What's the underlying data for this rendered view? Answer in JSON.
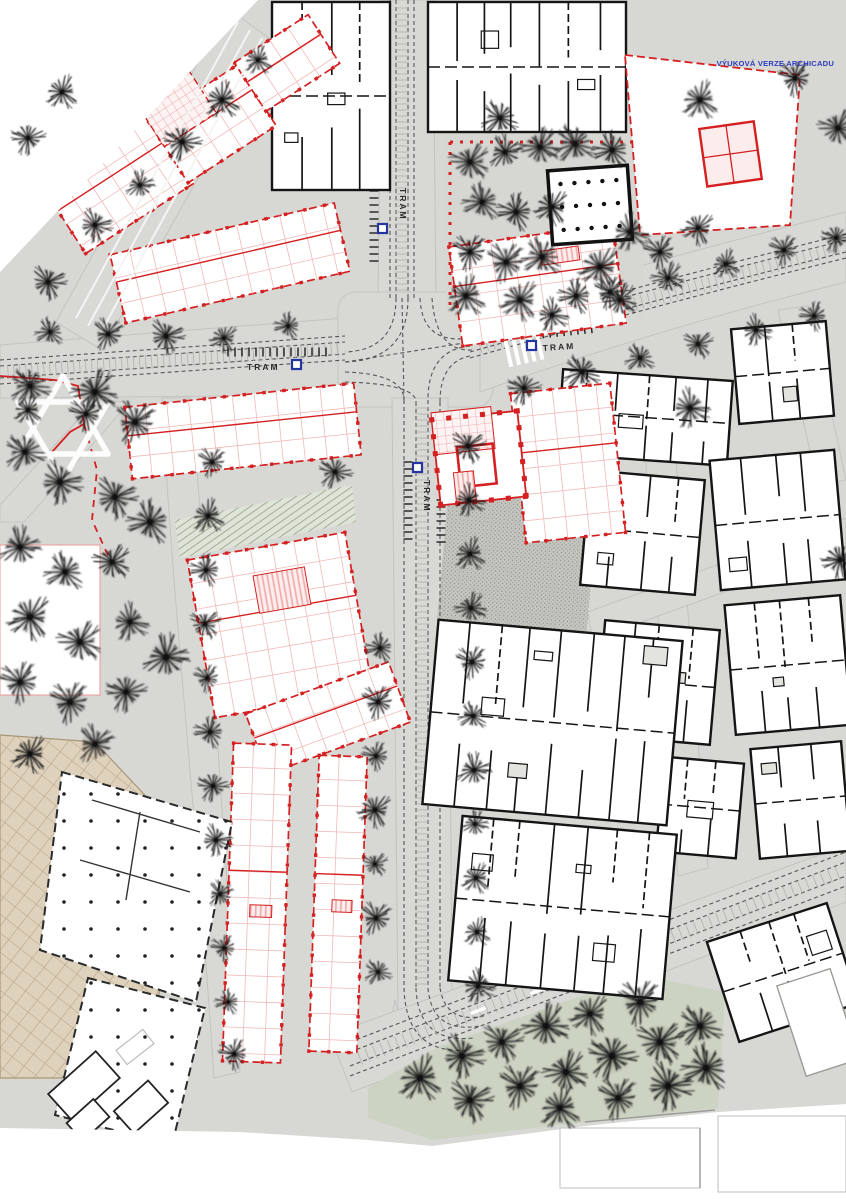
{
  "document": {
    "title": "Urban site plan with tram boulevard",
    "watermark": "VÝUKOVÁ VERZE ARCHICADU",
    "watermark_color": "#2b3cbe"
  },
  "map": {
    "tram_stops": [
      {
        "text": "TRAM",
        "location": "boulevard-north",
        "orientation": "vertical"
      },
      {
        "text": "TRAM",
        "location": "avenue-west",
        "orientation": "horizontal"
      },
      {
        "text": "TRAM",
        "location": "avenue-east",
        "orientation": "horizontal"
      },
      {
        "text": "TRAM",
        "location": "boulevard-south",
        "orientation": "vertical"
      }
    ],
    "landmarks": {
      "star_of_david": "white Star of David ground marking",
      "park_top": "tree square with red dotted boundary",
      "green_park": "lawn park bottom centre",
      "tan_plaza": "gridded paved plaza bottom left"
    },
    "palette": {
      "proposed_red": "#d42020",
      "existing_black": "#151515",
      "ground": "#e9e9e6",
      "road": "#d8d8d5",
      "park_green": "#cdd3c2",
      "plaza_tan": "#ded2bd",
      "stop_blue": "#23369f",
      "tree": "#1c1c1c",
      "star_white": "#ffffff"
    }
  }
}
